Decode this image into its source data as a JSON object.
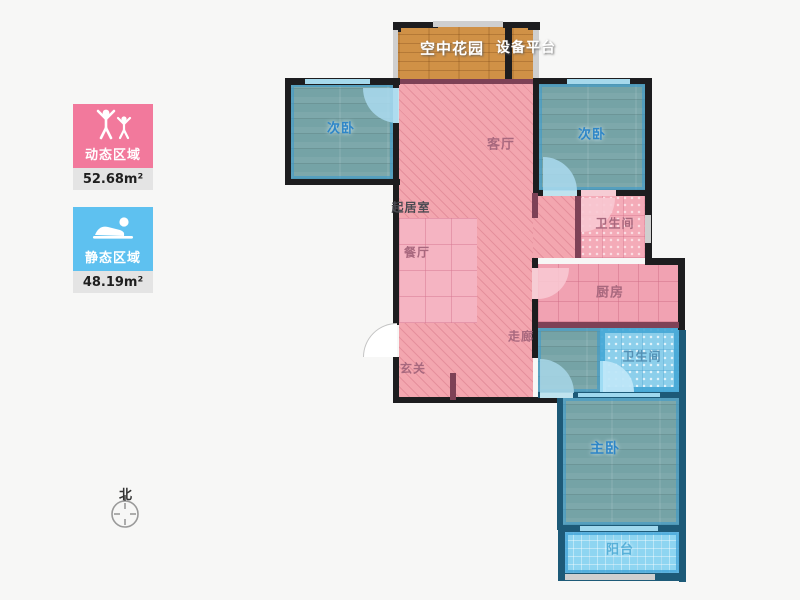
{
  "legend": {
    "dynamic": {
      "label": "动态区域",
      "value": "52.68m²",
      "color": "#f2799c"
    },
    "static": {
      "label": "静态区域",
      "value": "48.19m²",
      "color": "#5ec1f0"
    }
  },
  "compass": {
    "label": "北"
  },
  "rooms": {
    "sky_garden": "空中花园",
    "equipment_platform": "设备平台",
    "bedroom_left": "次卧",
    "bedroom_right": "次卧",
    "living_room": "客厅",
    "sitting_room": "起居室",
    "dining_room": "餐厅",
    "bathroom_top": "卫生间",
    "kitchen": "厨房",
    "corridor": "走廊",
    "entry": "玄关",
    "bathroom_bottom": "卫生间",
    "master_bedroom": "主卧",
    "balcony": "阳台"
  },
  "colors": {
    "dynamic_fill": "#f3a6af",
    "static_fill": "#75a3a6",
    "wall": "#1d1d1f",
    "wall_navy": "#1d5a78",
    "garden_wood": "#d09146"
  }
}
